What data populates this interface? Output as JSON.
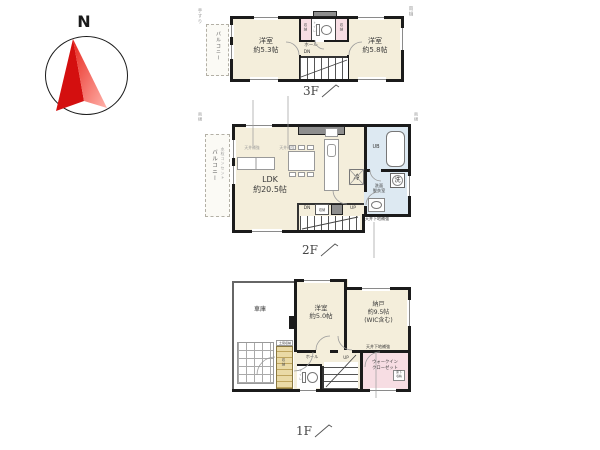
{
  "compass": {
    "north": "N"
  },
  "f3": {
    "floor_label": "3F",
    "balcony": "バルコニー",
    "note_handrail": "手すり",
    "note_gutter": "雨樋",
    "room_left": "洋室\n約5.3帖",
    "room_right": "洋室\n約5.8帖",
    "closet_left": "収納",
    "closet_right": "収納",
    "toilet": "トイレ",
    "hall": "ホール",
    "down": "DN"
  },
  "f2": {
    "floor_label": "2F",
    "balcony": "バルコニー",
    "balcony_note": "水栓コンセント",
    "note_gutter_left": "雨樋",
    "note_gutter_right": "雨樋",
    "ldk": "LDK\n約20.5帖",
    "ceiling_note_1": "天井補強",
    "ceiling_note_2": "天井補強",
    "fridge": "冷",
    "unit_bath": "UB",
    "washer": "洗",
    "washroom": "洗面\n脱衣室",
    "closet": "収納",
    "down": "DN",
    "up": "UP",
    "ceiling_reinforce": "天井下地補強"
  },
  "f1": {
    "floor_label": "1F",
    "garage": "車庫",
    "room": "洋室\n約5.0帖",
    "storage_room": "納戸\n約9.5帖\n(WIC含む)",
    "hall": "ホール",
    "toilet": "トイレ",
    "entrance_storage_top": "土間収納",
    "entrance_storage": "収納",
    "up": "UP",
    "walk_in_closet": "ウォークイン\nクローゼット",
    "floor_storage": "床下\n収納",
    "ceiling_reinforce": "天井下地補強"
  }
}
